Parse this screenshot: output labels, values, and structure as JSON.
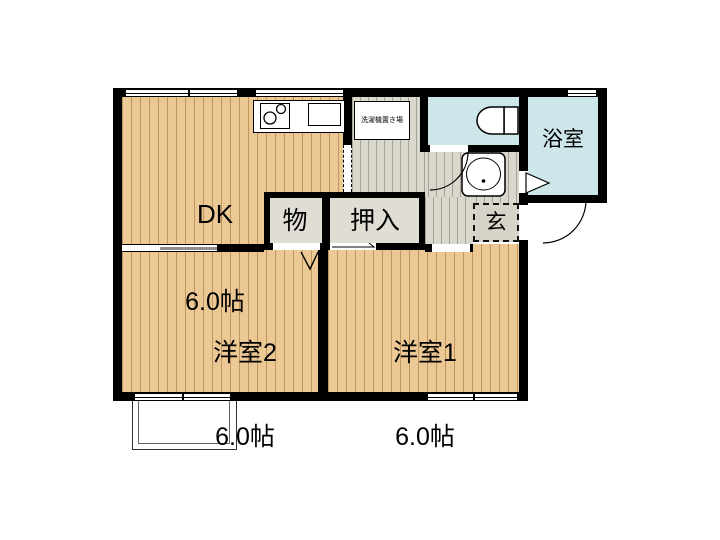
{
  "plan": {
    "rooms": {
      "dk": {
        "label": "DK",
        "size": "6.0帖"
      },
      "western1": {
        "label": "洋室1",
        "size": "6.0帖"
      },
      "western2": {
        "label": "洋室2",
        "size": "6.0帖"
      },
      "bath": {
        "label": "浴室"
      },
      "entrance": {
        "label": "玄"
      },
      "closet_small": {
        "label": "物"
      },
      "oshiire": {
        "label": "押入"
      },
      "laundry": {
        "label": "洗濯機置き場"
      }
    },
    "colors": {
      "tatami_floor": "#ecc994",
      "corridor_floor": "#dad7cd",
      "wet_room": "#cde6ea",
      "closet": "#e0ddd4",
      "wall": "#000000"
    },
    "icons": [
      "toilet-icon",
      "washbasin-icon",
      "stove-icon",
      "sink-icon",
      "folding-door-icon",
      "bath-door-icon",
      "door-arc"
    ]
  }
}
